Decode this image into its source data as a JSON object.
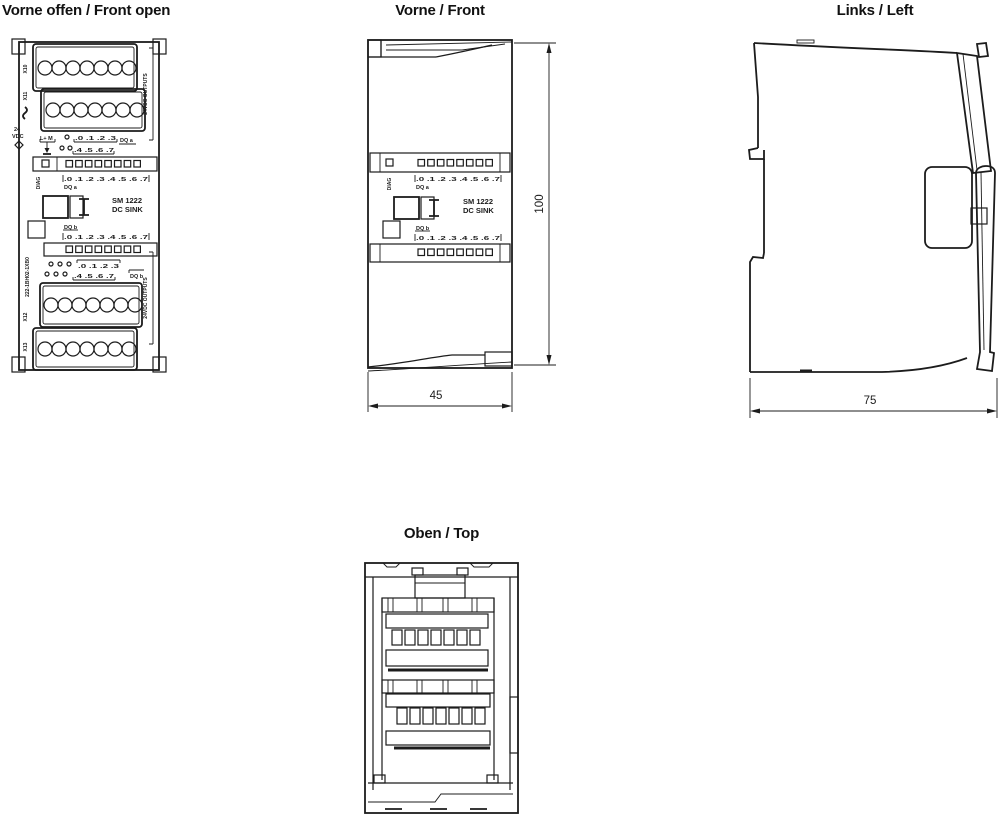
{
  "colors": {
    "ink": "#1c1c1c",
    "background": "#ffffff"
  },
  "titles": {
    "front_open": "Vorne offen / Front open",
    "front": "Vorne / Front",
    "left": "Links / Left",
    "top": "Oben / Top"
  },
  "module": {
    "name": "SM 1222",
    "type": "DC SINK",
    "part_number": "222-1BH02-1XB0",
    "diag": "DIAG",
    "dq_a": "DQ a",
    "dq_b": "DQ b",
    "led_scale": ".0 .1 .2 .3 .4 .5 .6 .7",
    "outputs": "24VDC OUTPUTS",
    "supply_line1": "24",
    "supply_line2": "VDC",
    "supply_terminals": "L+ M",
    "group_low": ".0 .1 .2 .3",
    "group_high": ".4 .5 .6 .7",
    "x10": "X10",
    "x11": "X11",
    "x12": "X12",
    "x13": "X13"
  },
  "dimensions": {
    "width": "45",
    "height": "100",
    "depth": "75"
  }
}
